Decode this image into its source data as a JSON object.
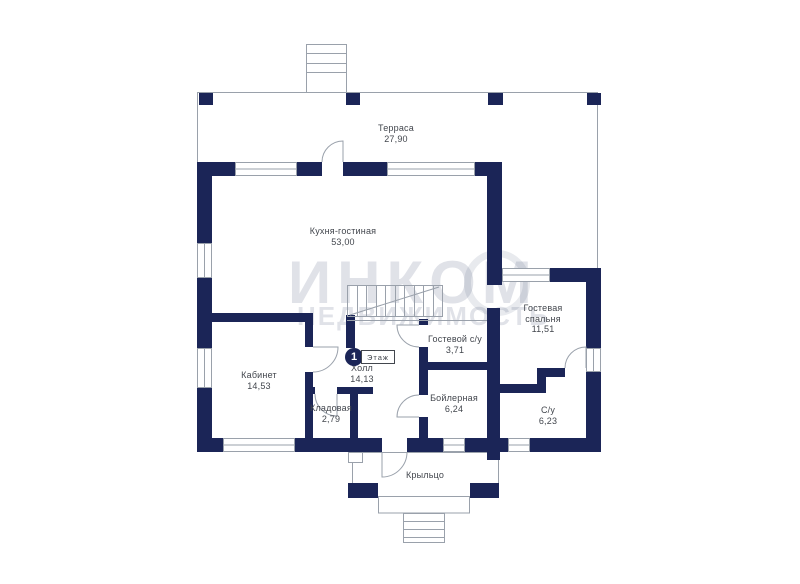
{
  "plan_title": "Floor plan, 1st floor",
  "floor_badge": {
    "number": "1",
    "label": "Этаж"
  },
  "watermark": {
    "line1": "ИНКОМ",
    "line2": "НЕДВИЖИМОСТЬ"
  },
  "rooms": [
    {
      "id": "terrace",
      "name": "Терраса",
      "area": "27,90"
    },
    {
      "id": "kitchen-living",
      "name": "Кухня-гостиная",
      "area": "53,00"
    },
    {
      "id": "office",
      "name": "Кабинет",
      "area": "14,53"
    },
    {
      "id": "hall",
      "name": "Холл",
      "area": "14,13"
    },
    {
      "id": "storage",
      "name": "Кладовая",
      "area": "2,79"
    },
    {
      "id": "guest-wc",
      "name": "Гостевой с/у",
      "area": "3,71"
    },
    {
      "id": "boiler",
      "name": "Бойлерная",
      "area": "6,24"
    },
    {
      "id": "guest-bedroom",
      "name": "Гостевая спальня",
      "area": "11,51"
    },
    {
      "id": "bathroom",
      "name": "С/у",
      "area": "6,23"
    },
    {
      "id": "porch",
      "name": "Крыльцо",
      "area": ""
    }
  ],
  "colors": {
    "wall": "#1b2557",
    "thin_line": "#9aa1ab",
    "label_text": "#42464d",
    "watermark": "#d9dce3",
    "background": "#ffffff"
  }
}
